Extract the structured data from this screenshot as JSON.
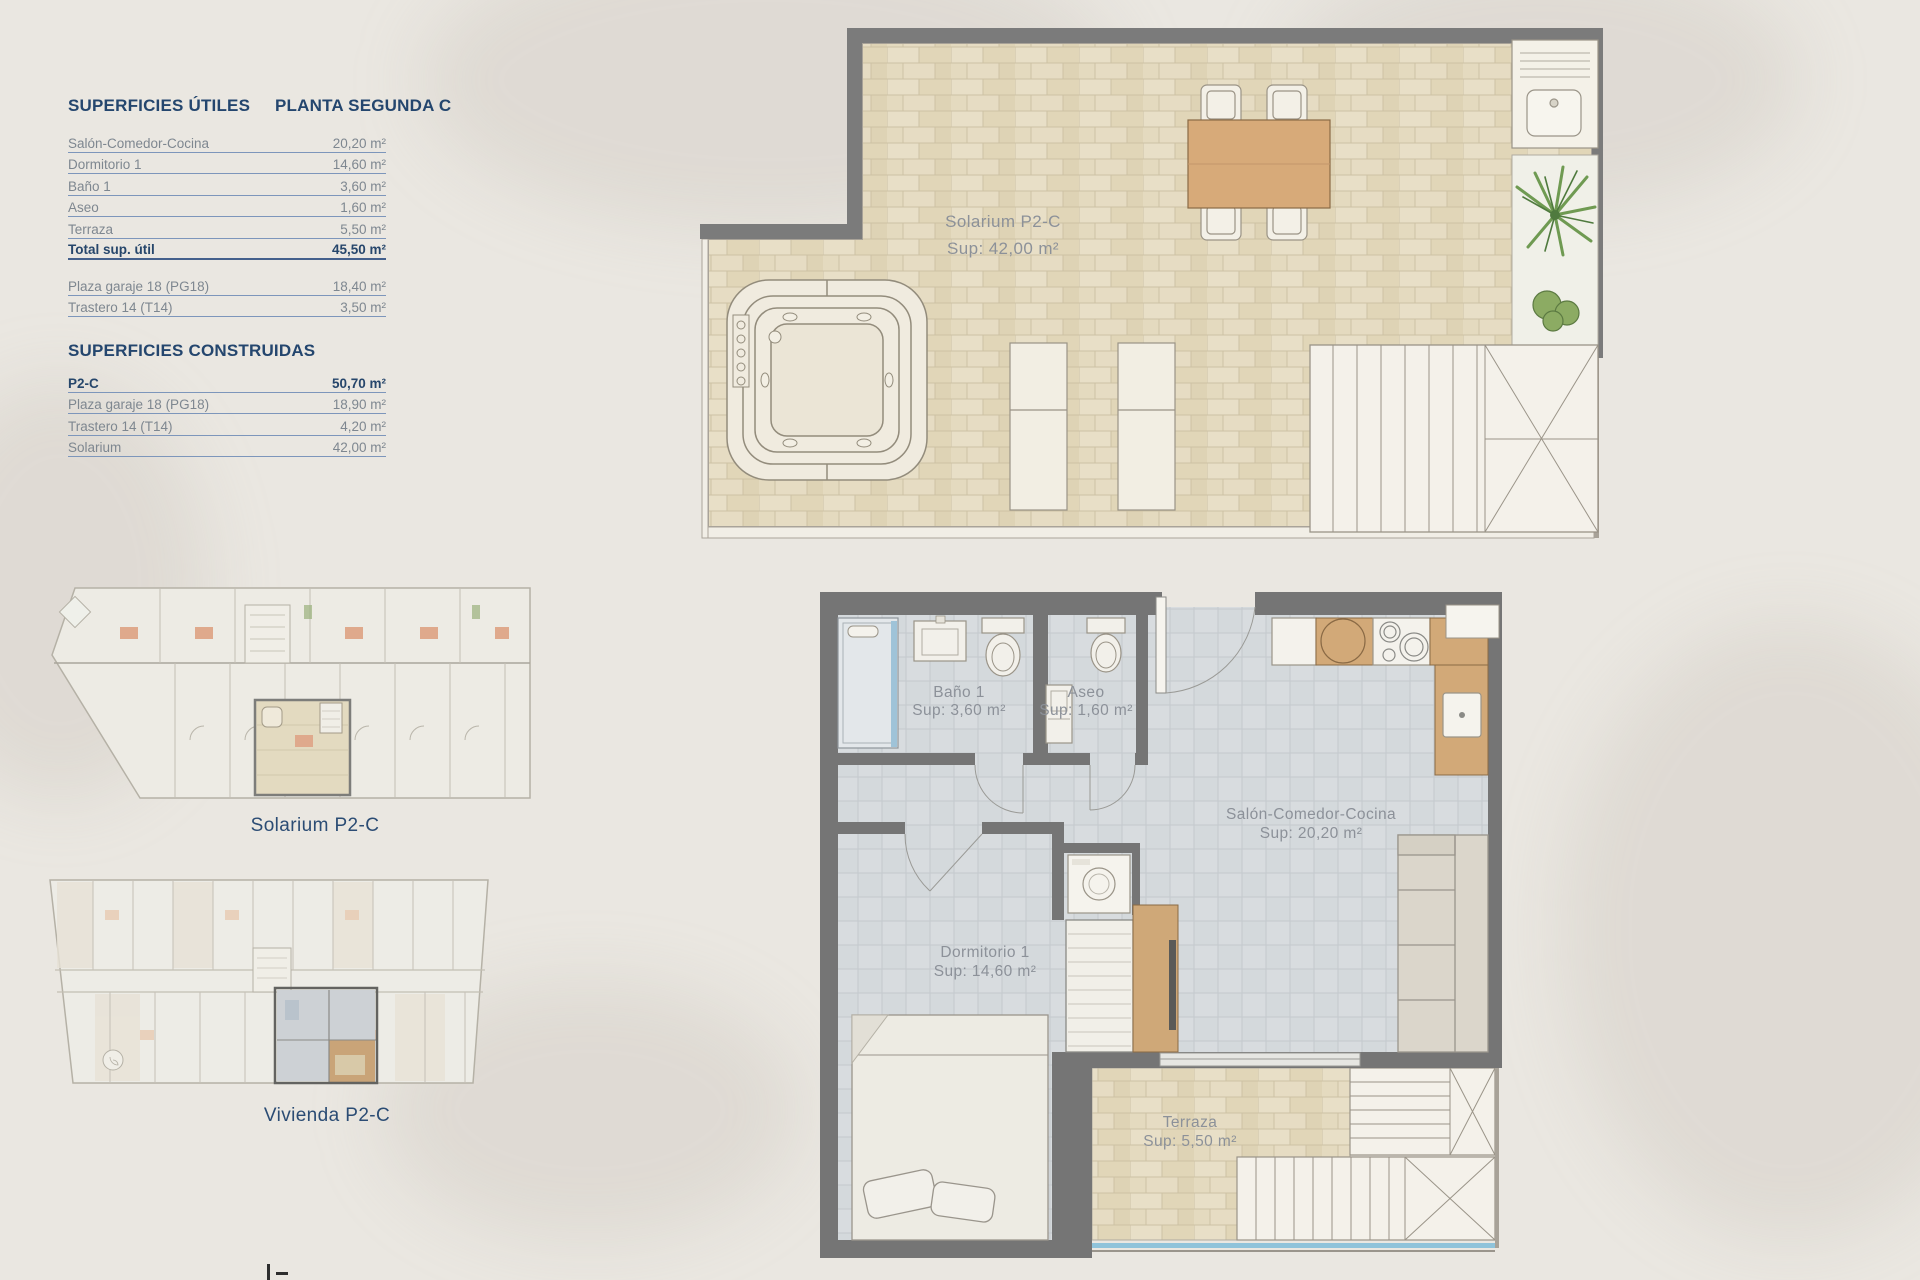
{
  "tables": {
    "utiles": {
      "title": "SUPERFICIES ÚTILES",
      "subtitle": "PLANTA SEGUNDA C",
      "rows": [
        {
          "label": "Salón-Comedor-Cocina",
          "value": "20,20 m²"
        },
        {
          "label": "Dormitorio 1",
          "value": "14,60 m²"
        },
        {
          "label": "Baño 1",
          "value": "3,60 m²"
        },
        {
          "label": "Aseo",
          "value": "1,60 m²"
        },
        {
          "label": "Terraza",
          "value": "5,50 m²"
        }
      ],
      "total": {
        "label": "Total sup. útil",
        "value": "45,50 m²"
      },
      "extras": [
        {
          "label": "Plaza garaje 18 (PG18)",
          "value": "18,40 m²"
        },
        {
          "label": "Trastero 14 (T14)",
          "value": "3,50 m²"
        }
      ]
    },
    "construidas": {
      "title": "SUPERFICIES CONSTRUIDAS",
      "rows": [
        {
          "label": "P2-C",
          "value": "50,70 m²"
        },
        {
          "label": "Plaza garaje 18 (PG18)",
          "value": "18,90 m²"
        },
        {
          "label": "Trastero 14 (T14)",
          "value": "4,20 m²"
        },
        {
          "label": "Solarium",
          "value": "42,00 m²"
        }
      ]
    }
  },
  "miniplans": {
    "solarium_label": "Solarium P2-C",
    "vivienda_label": "Vivienda P2-C"
  },
  "plans": {
    "solarium": {
      "name": "Solarium P2-C",
      "area": "Sup: 42,00 m²"
    },
    "rooms": {
      "bano": {
        "name": "Baño 1",
        "area": "Sup: 3,60 m²"
      },
      "aseo": {
        "name": "Aseo",
        "area": "Sup: 1,60 m²"
      },
      "salon": {
        "name": "Salón-Comedor-Cocina",
        "area": "Sup: 20,20 m²"
      },
      "dormitorio": {
        "name": "Dormitorio 1",
        "area": "Sup: 14,60 m²"
      },
      "terraza": {
        "name": "Terraza",
        "area": "Sup: 5,50 m²"
      }
    }
  },
  "colors": {
    "accent_navy": "#24466e",
    "row_grey": "#7e8790",
    "rule_blue": "#7d96bb",
    "wall_grey": "#757575",
    "tile_beige": "#e4dabf",
    "tile_grey": "#d8dcdf",
    "wood": "#d2a978",
    "glass_blue": "#8fc3da",
    "plant_green": "#6f9a52"
  }
}
